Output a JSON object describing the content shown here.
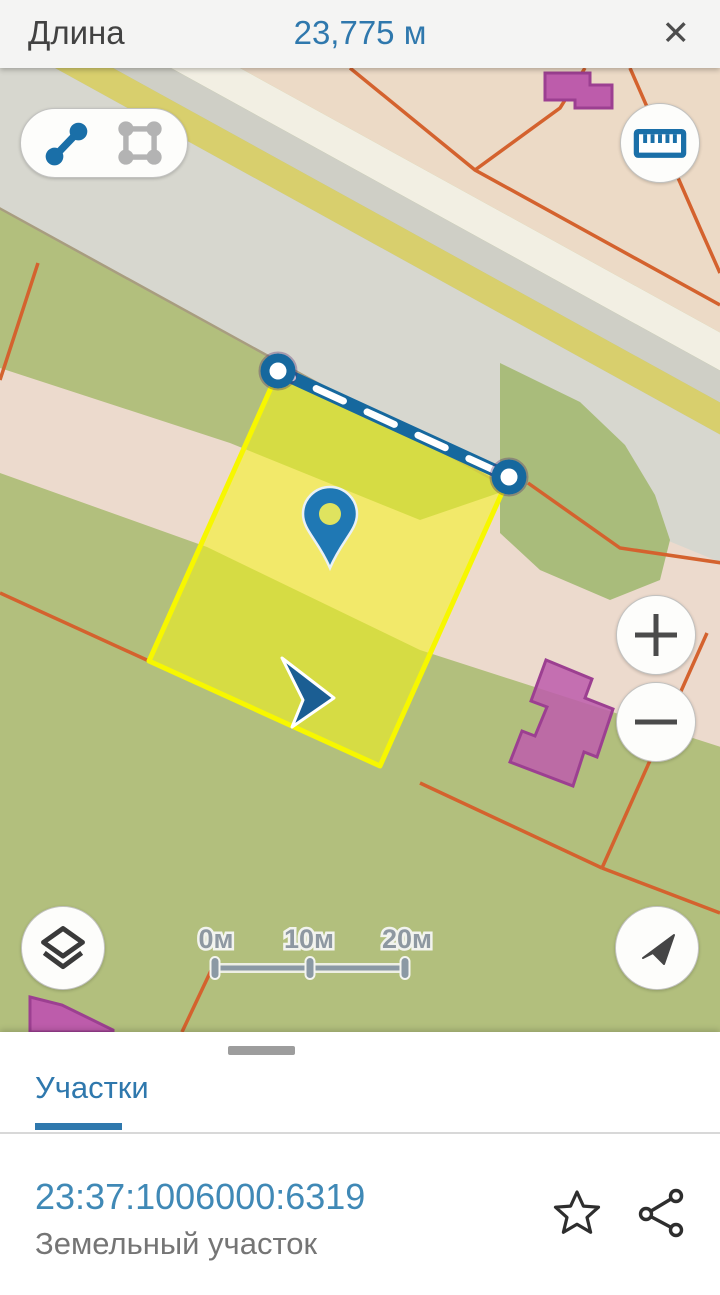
{
  "app_bar": {
    "title": "Длина",
    "value": "23,775 м",
    "close_icon": "✕"
  },
  "map": {
    "tools": {
      "line_tool_state": "active",
      "area_tool_state": "inactive"
    },
    "scale_bar": {
      "labels": [
        "0м",
        "10м",
        "20м"
      ]
    },
    "icons": {
      "line_tool": "measure-distance-icon",
      "area_tool": "measure-area-icon",
      "ruler": "ruler-icon",
      "zoom_in": "plus-icon",
      "zoom_out": "minus-icon",
      "layers": "layers-icon",
      "compass": "navigation-arrow-icon",
      "pin": "map-pin-icon",
      "cursor": "location-cursor-icon"
    }
  },
  "bottom_sheet": {
    "tab_label": "Участки",
    "parcel": {
      "cadastral_number": "23:37:1006000:6319",
      "type_label": "Земельный участок"
    }
  },
  "colors": {
    "accent": "#2f78ad",
    "link": "#4089b6",
    "parcel-yellow": "#f7f700",
    "measure-blue": "#16689e",
    "pin-blue": "#1f78b4",
    "map-orange": "#d4622e",
    "building-magenta": "#bd5cab"
  }
}
